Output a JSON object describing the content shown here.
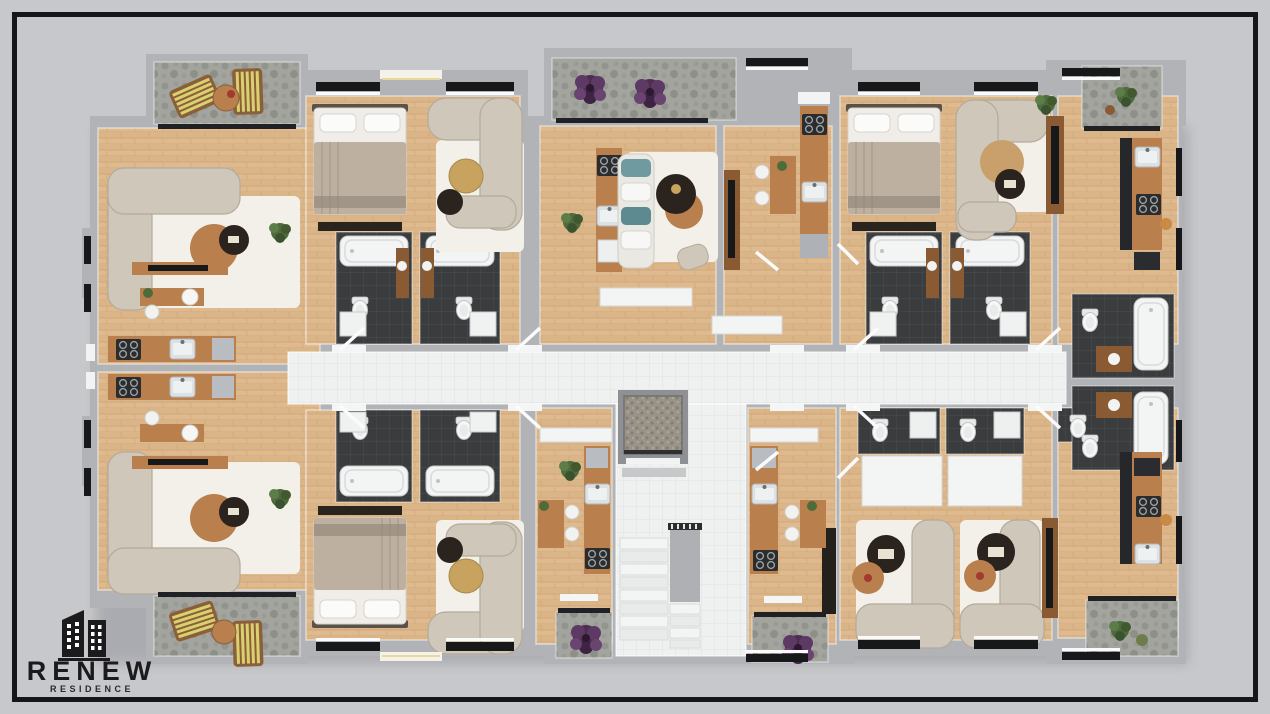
{
  "logo": {
    "title": "RENEW",
    "subtitle": "RESIDENCE",
    "icon": "twin-buildings-icon"
  },
  "scene": {
    "type": "3d-rendered-floor-plan",
    "description": "Top-down 3D render of one residential floor with eight apartments, a central white-tiled corridor, elevator and staircase core, dark-tiled bathrooms, wood-floored living areas and stone balconies",
    "inventory": [
      "balcony-loungers",
      "sun-lounger-table",
      "l-shaped-sofas",
      "curved-sofas",
      "white-sofa-teal-cushions",
      "area-rugs",
      "round-coffee-tables",
      "double-beds",
      "tv-consoles",
      "kitchens-with-stove-and-sink",
      "dining-tables",
      "bathtubs",
      "toilets",
      "vanity-sinks",
      "washing-machines",
      "elevator",
      "staircase",
      "purple-plants",
      "green-plants",
      "windows",
      "balcony-sliding-doors"
    ]
  },
  "palette": {
    "bg": "#c7c8cb",
    "frame": "#161618",
    "wall": "#b1b3b7",
    "wood": "#deba8e",
    "tile": "#eff1f1",
    "darkTile": "#3a3c3e",
    "stone": "#a3a49e",
    "white": "#f4f5f5",
    "sofa": "#cfc7ba",
    "rug": "#f2f0e9",
    "furnWood": "#b97f4d",
    "furnWoodDark": "#8a5a33",
    "furnDark": "#2b241e",
    "gold": "#c8a360",
    "bedBlanket": "#bdb0a1",
    "teal": "#6f9aa0",
    "purple": "#4f2d53",
    "green": "#4e6b3c",
    "lounger": "#d9d06f",
    "loungerFrame": "#8a5f39",
    "stair": "#f3f4f4",
    "rail": "#2f3033",
    "elevatorFloor": "#9a9389",
    "logoColor": "#1b1b1d"
  }
}
